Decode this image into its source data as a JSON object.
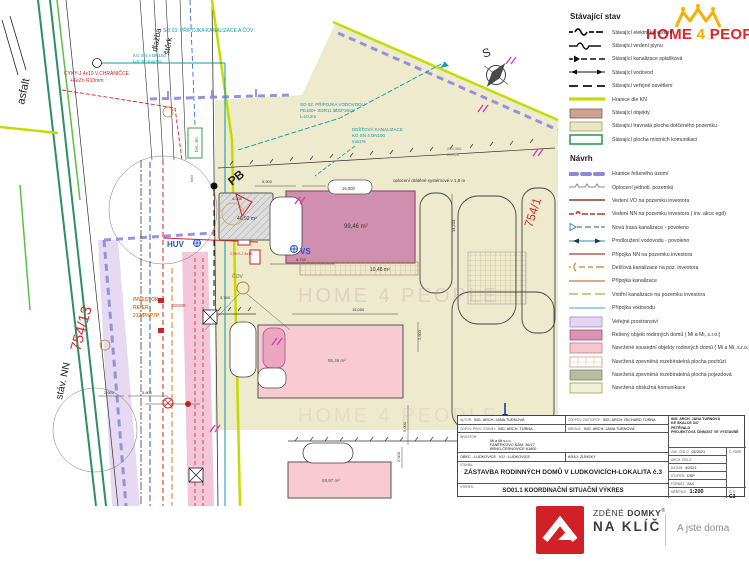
{
  "header_logo": {
    "home": "HOME",
    "four": "4",
    "people": "PEOPLE"
  },
  "legend": {
    "stavajici": {
      "title": "Stávající stav",
      "items": [
        "Stávající elektrické vedení",
        "Stávající vedení plynu",
        "Stávající kanalizace splašková",
        "Stávající vodovod",
        "Stávající veřejné osvětlení",
        "Hranice dle KN",
        "Stávající objekty",
        "Stávající travnatá plocha dotčeného pozemku",
        "Stávající plocha místních komunikací"
      ]
    },
    "navrh": {
      "title": "Návrh",
      "items": [
        "Hranice řešeného území",
        "Oplocení jednotl. pozemků",
        "Vedení VO na pozemku investora",
        "Vedení NN na pozemku investora ( inv. akce egd)",
        "Nová trasa kanalizace - povoleno",
        "Prodloužení vodovodu - povoleno",
        "Přípojka NN na pozemku investora",
        "Dešťová kanalizace na poz. investora",
        "Přípojka kanalizace",
        "Vnitřní kanalizace na pozemku investora",
        "Přípojka vodovodu",
        "Veřejné prostranství",
        "Řešený objekt rodinných domů ( Mi a Mi, s.r.o.)",
        "Navržené sousední objekty rodinných domů ( Mi a Mi, s.r.o.)",
        "Navržená zpevněná rozebíratelná plocha pochůzí",
        "Navržená zpevněná rozebíratelná plocha pojezdová",
        "Navržená obslužná komunikace"
      ]
    }
  },
  "plan": {
    "notes": {
      "so03_1": "SO 03: PŘÍPOJKA KANALIZACE A ČOV",
      "so03_2": "KG SN 4 DN150",
      "so03_3": "l=5,3m min2%",
      "so02_1": "SO 02: PŘÍPOJKA VODOVODU",
      "so02_2": "PE100+ SDR11 lØ32*3mm",
      "so02_3": "l=10,2m",
      "dest_1": "DEŠŤOVÁ KANALIZACE",
      "dest_2": "KG SN 4 DN100",
      "dest_3": "min2%",
      "lvl_1": "269,366",
      "lvl_2": "269,26",
      "cyky_1": "CYKY-J 4x10 V.CHRÁNIČCE",
      "cyky_2": "+FeZn R10mm",
      "cyky_3": "CYKY-J 4x16",
      "oploceni": "oplocení drátěné systémové v 1,8 m"
    },
    "labels": {
      "asfalt": "asfalt",
      "dlazba": "dlažba",
      "sterk": "štěrk",
      "bet_skl": "bet. skl.",
      "kolo": "kolo",
      "pb": "PB",
      "huv": "HUV",
      "vs": "VS",
      "cov": "ČOV",
      "inv_1": "INVESTOR",
      "inv_2": "RE-ER",
      "inv_3": "212/PHP7P",
      "ss": "SS200",
      "stav_nn": "stáv. NN",
      "p754_13": "754/13",
      "p754_1": "754/1",
      "compass": "S",
      "watermark": "HOME 4 PEOPLE"
    },
    "areas": {
      "a1": "46,92 m²",
      "a2": "99,46 m²",
      "a3": "10,48 m²",
      "a4": "95,46 m²",
      "a5": "59,97 m²"
    },
    "dims": {
      "d1": "5,900",
      "d2": "15,000",
      "d3": "4,200",
      "d4": "8,740",
      "d5": "3,760",
      "d6": "14,203",
      "d7": "2,900",
      "d8": "15,050",
      "d9": "5,000",
      "d10": "2,000",
      "d11": "5,800",
      "d12": "2,000"
    }
  },
  "titleblock": {
    "autor_label": "AUTOR:",
    "autor": "ING. ARCH. JANA TURNOVÁ",
    "zodpov_label": "ZODPOV. ZÁSTUPCE:",
    "zodpov": "ING. ARCH. RICHARD TURNA",
    "odpov_label": "ODPOV. PROJ. STAVBY:",
    "odpov": "ING. ARCH. TURNA",
    "kreslil_label": "KRESLIL:",
    "kreslil": "ING. ARCH. JANA TURNOVÁ",
    "firma_1": "ING. ARCH. JANA TURNOVÁ",
    "firma_2": "KE SKALCE 347",
    "firma_3": "PETŘVALD",
    "firma_4": "PROJEKTOVÁ ČINNOST VE VÝSTAVBĚ",
    "investor_label": "INVESTOR:",
    "investor_1": "Mi a Mi s.r.o.",
    "investor_2": "FANĚRKOVO NÁM. 36/17",
    "investor_3": "BRNO-ČERNOVICE 61800",
    "obec": "OBEC - LUDKOVICE",
    "ku": "KÚ - LUDKOVICE",
    "kraj": "KRAJ: ZLÍNSKÝ",
    "stavba_label": "STAVBA:",
    "stavba": "ZÁSTAVBA RODINNÝCH DOMŮ V LUDKOVICÍCH-LOKALITA č.3",
    "vykres_label": "VÝKRES:",
    "vykres": "SO01.1 KOORDINAČNÍ SITUAČNÍ VÝKRES",
    "zak_label": "ZAK. ČÍSLO:",
    "zak": "04/2021",
    "arch_label": "ARCH. ČÍSLO:",
    "arch": "",
    "datum_label": "DATUM:",
    "datum": "4/2021",
    "stupen_label": "STUPEŇ:",
    "stupen": "DSP",
    "format_label": "FORMÁT:",
    "format": "2A4",
    "meritko_label": "MĚŘÍTKO:",
    "meritko": "1:200",
    "cv_label": "Č. V.",
    "cv": "C3",
    "pare_label": "Č. PARÉ"
  },
  "footer": {
    "zdene": "ZDĚNÉ",
    "domky": "DOMKY",
    "reg": "®",
    "naklic": "NA KLÍČ",
    "tagline": "A jste doma"
  },
  "colors": {
    "brand_red": "#cf2127",
    "brand_yellow": "#f5b000",
    "kn_green": "#c3dc00",
    "boundary_purple": "#8a8ad8",
    "building_pink": "#d18fb0"
  }
}
